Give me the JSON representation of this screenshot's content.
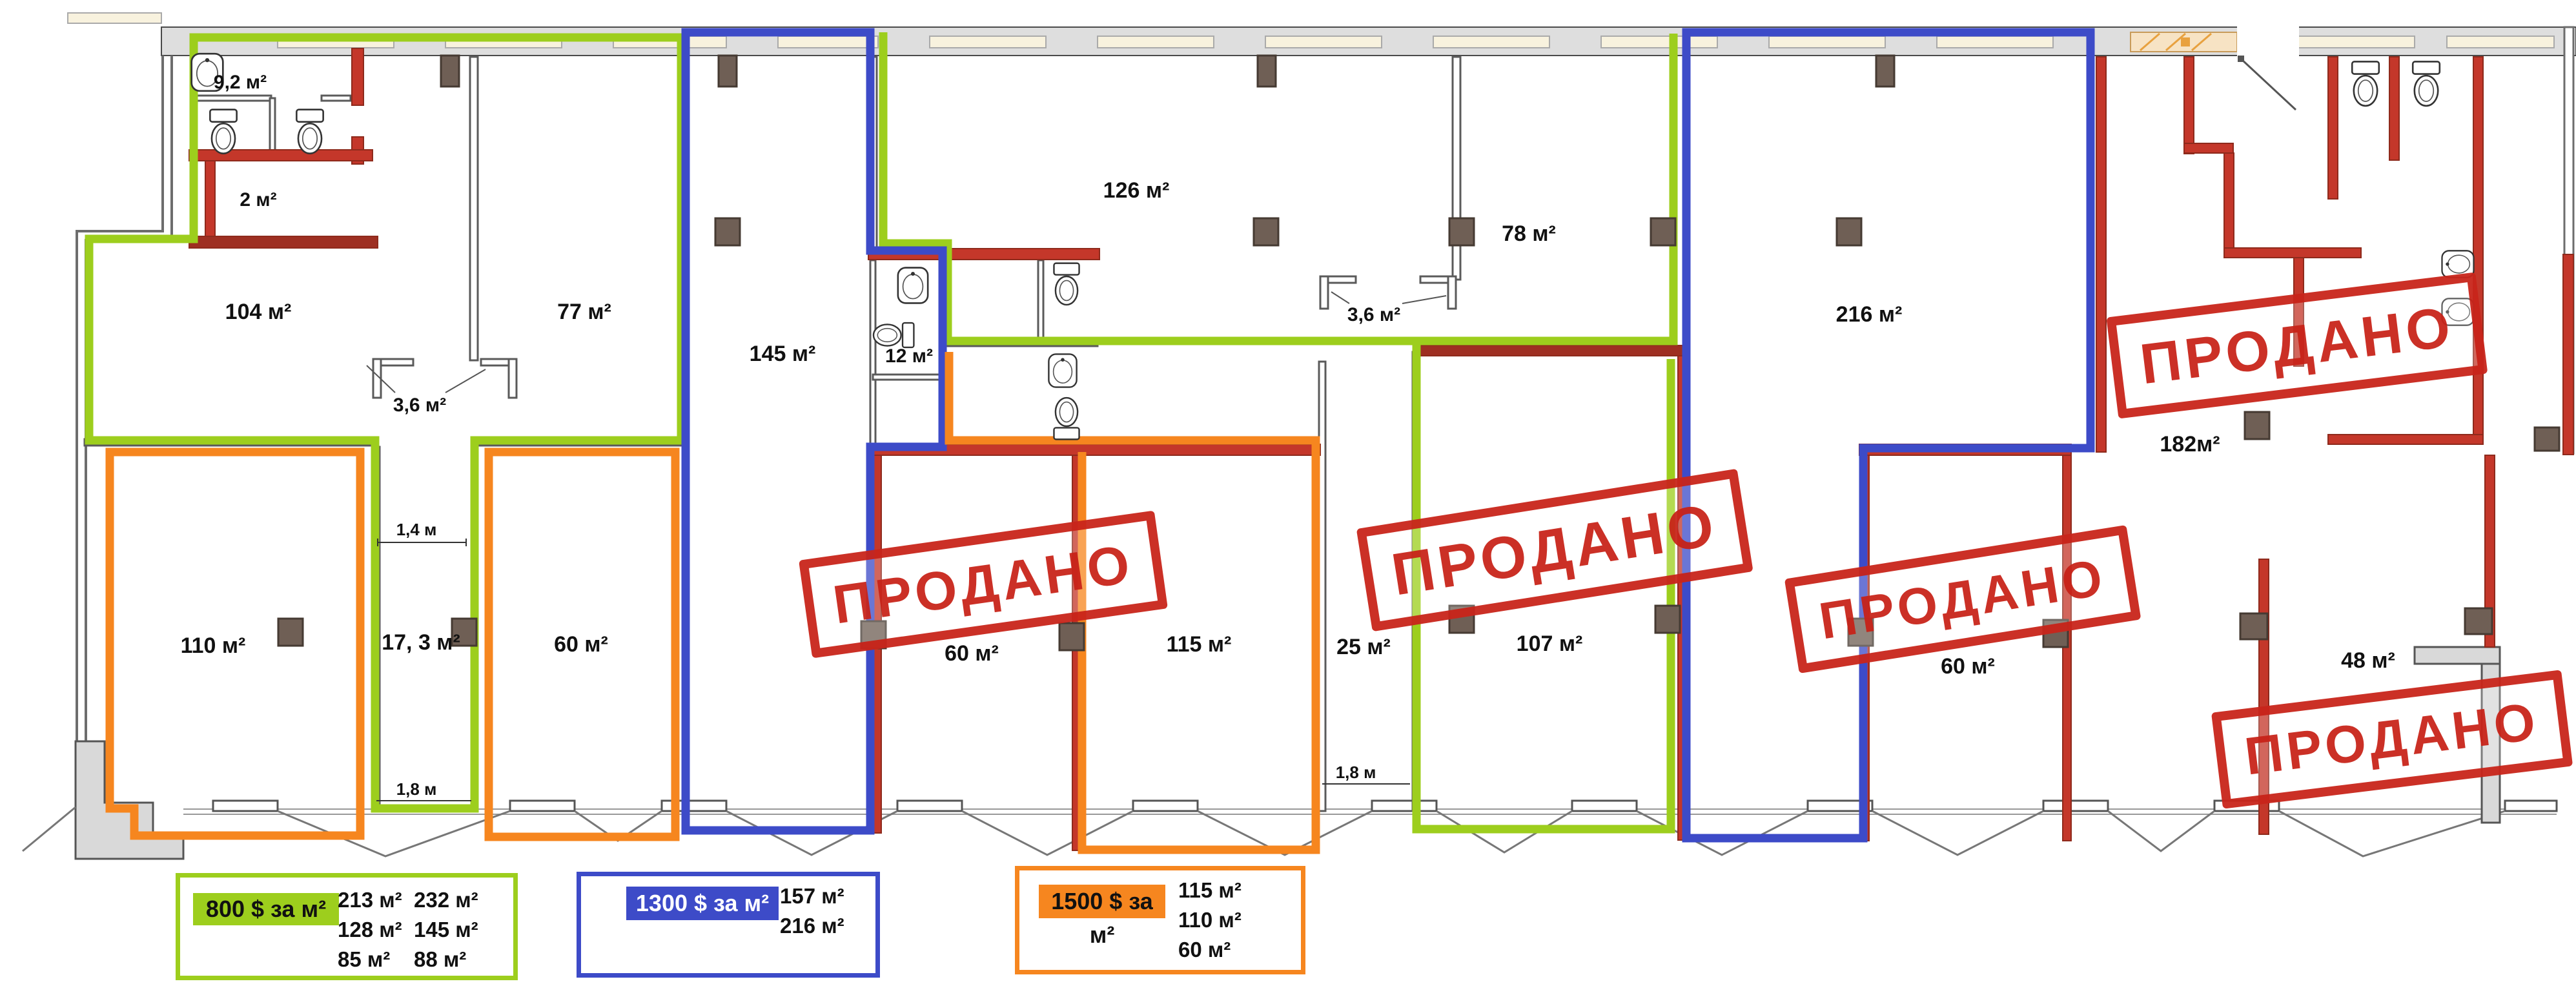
{
  "stamp": {
    "sold_label": "ПРОДАНО"
  },
  "rooms": {
    "r9_2": "9,2 м²",
    "r2": "2 м²",
    "r104": "104 м²",
    "r77": "77 м²",
    "r3_6a": "3,6 м²",
    "r145": "145 м²",
    "r12": "12 м²",
    "r126": "126 м²",
    "r3_6b": "3,6 м²",
    "r78": "78 м²",
    "r216": "216 м²",
    "r182": "182м²",
    "r110": "110 м²",
    "r17_3": "17, 3 м²",
    "r60a": "60 м²",
    "r60b": "60 м²",
    "r115": "115 м²",
    "r25": "25 м²",
    "r107": "107 м²",
    "r60c": "60 м²",
    "r48": "48 м²"
  },
  "dimensions": {
    "w1_4": "1,4 м",
    "w1_8_left": "1,8 м",
    "w1_8_right": "1,8 м"
  },
  "legend": {
    "green": {
      "price_label": "800 $ за м²",
      "areas": [
        "213 м²",
        "128 м²",
        "85 м²",
        "232 м²",
        "145 м²",
        "88 м²"
      ]
    },
    "blue": {
      "price_label": "1300 $ за м²",
      "areas": [
        "157 м²",
        "216 м²"
      ]
    },
    "orange": {
      "price_label": "1500 $ за м²",
      "areas": [
        "115 м²",
        "110 м²",
        "60 м²"
      ]
    }
  },
  "colors": {
    "green": "#9DCE1D",
    "blue": "#3D4BC8",
    "orange": "#F6861F",
    "wall_red": "#C4372A",
    "stamp_red": "#C9251B"
  }
}
